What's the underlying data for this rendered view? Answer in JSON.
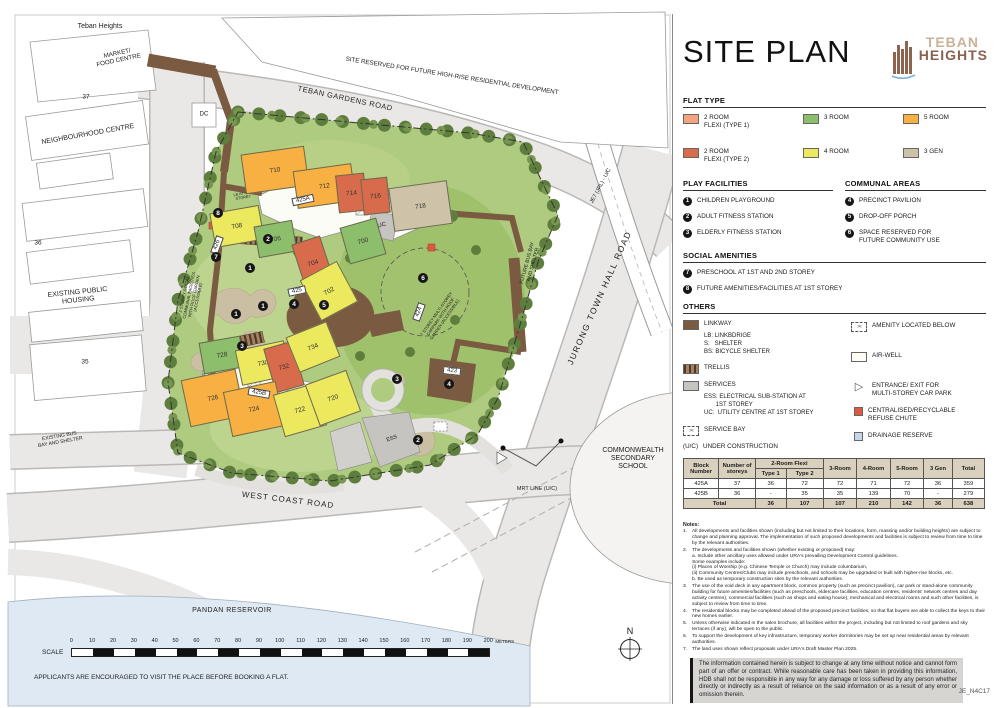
{
  "sheet": {
    "header": "Teban Heights",
    "footer_note": "APPLICANTS ARE ENCOURAGED TO VISIT THE PLACE BEFORE BOOKING A FLAT.",
    "ref_code": "JE_N4C17"
  },
  "map": {
    "labels": {
      "market": "MARKET/\nFOOD CENTRE",
      "site_reserved": "SITE RESERVED FOR FUTURE HIGH-RISE RESIDENTIAL DEVELOPMENT",
      "teban_gardens_road": "TEBAN GARDENS ROAD",
      "neighbourhood_centre": "NEIGHBOURHOOD CENTRE",
      "block_37": "37",
      "block_36": "36",
      "block_35": "35",
      "dc": "DC",
      "jrl_line": "JE7 (JRL) - U/C",
      "jurong_town_hall_road": "JURONG TOWN HALL ROAD",
      "existing_public_housing": "EXISTING PUBLIC\nHOUSING",
      "existing_bus_bay": "EXISTING BUS\nBAY AND SHELTER",
      "future_bus_bay": "FUTURE BUS BAY\nAND SHELTER",
      "commonwealth_school": "COMMONWEALTH\nSECONDARY\nSCHOOL",
      "mrt_line": "MRT LINE (U/C)",
      "west_coast_road": "WEST COAST ROAD",
      "pandan_reservoir": "PANDAN RESERVOIR",
      "communal_note": "2 STOREY SOCIAL COMMUNAL FACILITIES WITH ROOF GARDEN (ACCESSIBLE)",
      "mscp_note": "7 STOREY MULTI-STOREY CARPARK WITH ROOF GARDEN (ACCESSIBLE)",
      "lb_note_1": "LB AT 4TH STOREY",
      "lb_note_2": "LB AT 4TH STOREY",
      "uc": "UC",
      "ess": "ESS"
    },
    "blocks": [
      "710",
      "712",
      "714",
      "716",
      "718",
      "708",
      "706",
      "704",
      "702",
      "700",
      "728",
      "730",
      "732",
      "734",
      "726",
      "724",
      "722",
      "720"
    ],
    "facility_tags": [
      "425A",
      "425B",
      "425",
      "424",
      "423",
      "426"
    ],
    "markers": [
      "8",
      "7",
      "2",
      "1",
      "1",
      "1",
      "3",
      "3",
      "4",
      "4",
      "5",
      "6",
      "2"
    ]
  },
  "scale_bar": {
    "label": "SCALE",
    "ticks": [
      "0",
      "10",
      "20",
      "30",
      "40",
      "50",
      "60",
      "70",
      "80",
      "90",
      "100",
      "110",
      "120",
      "130",
      "140",
      "150",
      "160",
      "170",
      "180",
      "190",
      "200"
    ],
    "units": "METERS",
    "north": "N"
  },
  "panel": {
    "title": "SITE PLAN",
    "logo": {
      "line1": "TEBAN",
      "line2": "HEIGHTS"
    },
    "flat_type": {
      "heading": "FLAT TYPE",
      "items": [
        {
          "label": "2 ROOM\nFLEXI (TYPE 1)",
          "color": "#F2A47E"
        },
        {
          "label": "2 ROOM\nFLEXI (TYPE 2)",
          "color": "#D96B4D"
        },
        {
          "label": "3 ROOM",
          "color": "#8DBE6C"
        },
        {
          "label": "4 ROOM",
          "color": "#EDE95E"
        },
        {
          "label": "5 ROOM",
          "color": "#F7B041"
        },
        {
          "label": "3 GEN",
          "color": "#CEC3A8"
        }
      ]
    },
    "play_facilities": {
      "heading": "PLAY FACILITIES",
      "items": [
        {
          "n": "1",
          "label": "CHILDREN PLAYGROUND"
        },
        {
          "n": "2",
          "label": "ADULT FITNESS STATION"
        },
        {
          "n": "3",
          "label": "ELDERLY FITNESS STATION"
        }
      ]
    },
    "communal_areas": {
      "heading": "COMMUNAL AREAS",
      "items": [
        {
          "n": "4",
          "label": "PRECINCT PAVILION"
        },
        {
          "n": "5",
          "label": "DROP-OFF PORCH"
        },
        {
          "n": "6",
          "label": "SPACE RESERVED FOR\nFUTURE COMMUNITY USE"
        }
      ]
    },
    "social_amenities": {
      "heading": "SOCIAL AMENITIES",
      "items": [
        {
          "n": "7",
          "label": "PRESCHOOL AT 1ST AND 2ND STOREY"
        },
        {
          "n": "8",
          "label": "FUTURE AMENITIES/FACILITIES AT 1ST STOREY"
        }
      ]
    },
    "others": {
      "heading": "OTHERS",
      "linkway": {
        "label": "LINKWAY",
        "color": "#7A5A40",
        "sub": "LB: LINKBDRIGE\nS:   SHELTER\nBS: BICYCLE SHELTER"
      },
      "trellis": {
        "label": "TRELLIS",
        "color": "#6B4A33"
      },
      "services": {
        "label": "SERVICES",
        "color": "#C6C4C1",
        "sub": "ESS: ELECTRICAL SUB-STATION AT\n       1ST STOREY\nUC:  UTILITY CENTRE AT 1ST STOREY"
      },
      "service_bay": {
        "label": "SERVICE BAY",
        "icon": "><"
      },
      "under_construction": {
        "prefix": "(U/C)",
        "label": "UNDER CONSTRUCTION"
      },
      "amenity_below": {
        "label": "AMENITY LOCATED BELOW",
        "icon": "><"
      },
      "air_well": {
        "label": "AIR-WELL"
      },
      "mscp_entrance": {
        "label": "ENTRANCE/ EXIT FOR\nMULTI-STOREY CAR PARK",
        "icon": "▷"
      },
      "refuse_chute": {
        "label": "CENTRALISED/RECYCLABLE\nREFUSE CHUTE",
        "color": "#E0583E"
      },
      "drainage_reserve": {
        "label": "DRAINAGE RESERVE",
        "color": "#C7D6E8"
      }
    },
    "table": {
      "col_block": "Block Number",
      "col_storeys": "Number of storeys",
      "col_2room": "2-Room Flexi",
      "col_type1": "Type 1",
      "col_type2": "Type 2",
      "col_3room": "3-Room",
      "col_4room": "4-Room",
      "col_5room": "5-Room",
      "col_3gen": "3 Gen",
      "col_total": "Total",
      "rows": [
        {
          "block": "425A",
          "storeys": "37",
          "t1": "36",
          "t2": "72",
          "r3": "72",
          "r4": "71",
          "r5": "72",
          "g3": "36",
          "total": "359"
        },
        {
          "block": "425B",
          "storeys": "36",
          "t1": "-",
          "t2": "35",
          "r3": "35",
          "r4": "139",
          "r5": "70",
          "g3": "-",
          "total": "279"
        }
      ],
      "total_label": "Total",
      "totals": {
        "t1": "36",
        "t2": "107",
        "r3": "107",
        "r4": "210",
        "r5": "142",
        "g3": "36",
        "total": "638"
      }
    },
    "notes_heading": "Notes:",
    "notes": [
      {
        "n": "1.",
        "text": "All developments and facilities shown (including but not limited to their locations, form, massing and/or building heights) are subject to change and planning approval. The implementation of such proposed developments and facilities is subject to review from time to time by the relevant authorities."
      },
      {
        "n": "2.",
        "text": "The developments and facilities shown (whether existing or proposed) may:\na. Include other ancillary uses allowed under URA's prevailing Development Control guidelines.\nSome examples include:\n(i) Places of Worship (e.g. Chinese Temple or Church) may include columbarium,\n(ii) Community Centres/Clubs may include preschools, and schools may be upgraded or built with higher-rise blocks, etc.\nb. Be used as temporary construction sites by the relevant authorities."
      },
      {
        "n": "3.",
        "text": "The use of the void deck in any apartment block, common property (such as precinct pavilion), car park or stand-alone community building for future amenities/facilities (such as preschools, eldercare facilities, education centres, residents' network centres and day activity centres), commercial facilities (such as shops and eating house), mechanical and electrical rooms and such other facilities, is subject to review from time to time."
      },
      {
        "n": "4.",
        "text": "The residential blocks may be completed ahead of the proposed precinct facilities, so that flat buyers are able to collect the keys to their new homes earlier."
      },
      {
        "n": "5.",
        "text": "Unless otherwise indicated in the sales brochure, all facilities within the project, including but not limited to roof gardens and sky terraces (if any), will be open to the public."
      },
      {
        "n": "6.",
        "text": "To support the development of key infrastructure, temporary worker dormitories may be set up near residential areas by relevant authorities."
      },
      {
        "n": "7.",
        "text": "The land uses shown reflect proposals under URA's Draft Master Plan 2025."
      }
    ],
    "disclaimer": "The information contained herein is subject to change at any time without notice and cannot form part of an offer or contract. While reasonable care has been taken in providing this information, HDB shall not be responsible in any way for any damage or loss suffered by any person whether directly or indirectly as a result of reliance on the said information or as a result of any error or omission therein."
  }
}
